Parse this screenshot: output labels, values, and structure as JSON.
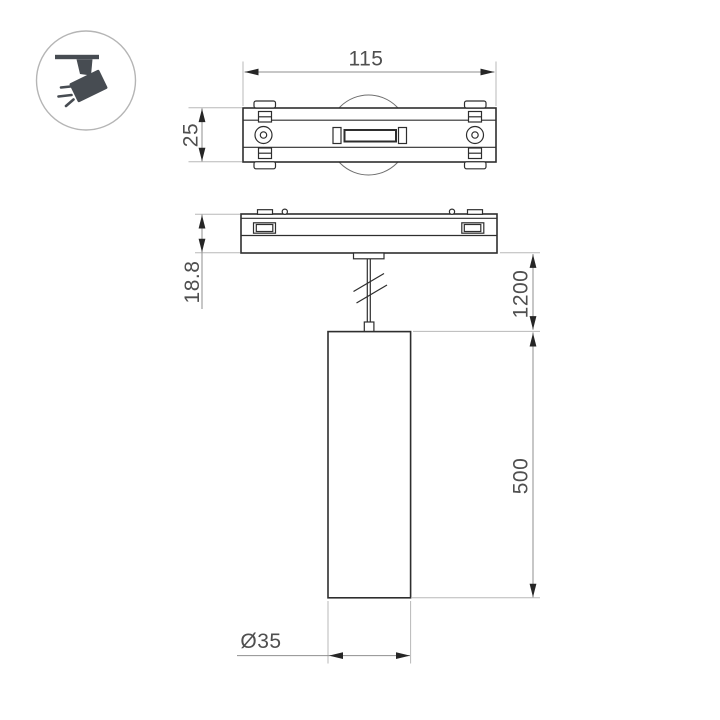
{
  "page": {
    "background": "#ffffff",
    "width": 720,
    "height": 720
  },
  "icon": {
    "name": "ceiling-track-spotlight",
    "outline_color": "#b5b5b5",
    "glyph_color": "#474c52"
  },
  "drawing": {
    "type": "technical-dimension-drawing",
    "subject": "magnetic track pendant spot lamp",
    "outline_color": "#2e2e2e",
    "dimension_line_color": "#8f8f8f",
    "extension_line_color": "#b8b8b8",
    "label_color": "#4f4f4f"
  },
  "dimensions": {
    "track_base_length": "115",
    "track_base_width": "25",
    "track_base_height": "18.8",
    "suspension_length": "1200",
    "lamp_body_length": "500",
    "lamp_diameter": "Ø35"
  }
}
